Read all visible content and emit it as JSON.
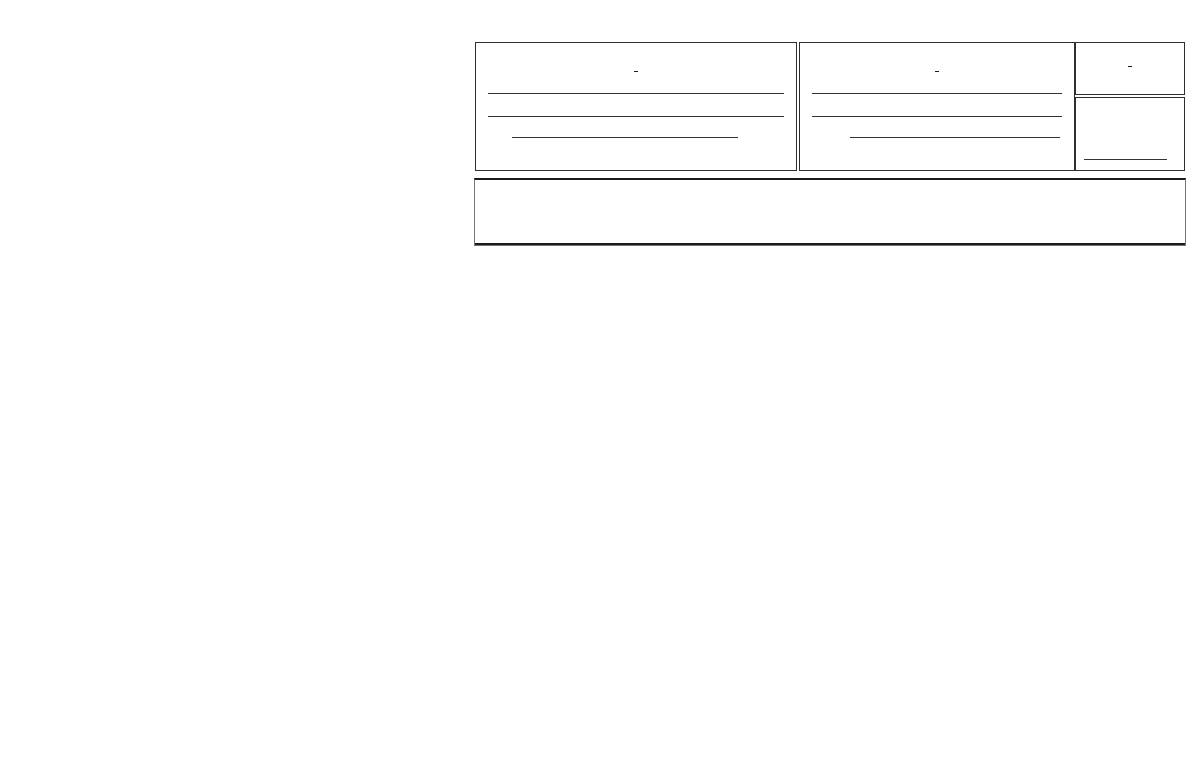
{
  "title": "HOUSING ASSISTANCE PAYMENTS REGISTER",
  "owner_section": {
    "heading": "OWNER",
    "name_label": "Name",
    "address_label": "Address",
    "zip_code_label": "Zip Code"
  },
  "family_section": {
    "heading": "FAMILY",
    "name_label": "Name",
    "address_label": "Address",
    "zip_code_label": "Zip Code"
  },
  "voucher_section": {
    "heading": "VOUCHER NO."
  },
  "unit_size_section": {
    "label": "Unit Size",
    "bedroom_label": "BR."
  },
  "register_table": {
    "columns": [
      {
        "lines": [
          "Effective",
          "Date of",
          "Lease"
        ],
        "number": "(1)"
      },
      {
        "lines": [
          "Expiration",
          "Date of",
          "Lease"
        ],
        "number": "(2)"
      },
      {
        "lines": [
          "Term.",
          "Notice",
          "Required",
          "(days)"
        ],
        "number": "(3)"
      },
      {
        "lines": [
          "Term.",
          "Notice",
          "Given",
          "(days)"
        ],
        "number": "(4)"
      },
      {
        "lines": [
          "Date",
          "Vacated"
        ],
        "number": "(5)"
      },
      {
        "lines": [
          "Days of",
          "Vacancy",
          "Due",
          "Owner"
        ],
        "number": "(6)"
      },
      {
        "lines": [
          "Effective",
          "Date of",
          "Payment",
          "Change"
        ],
        "number": "(7)"
      },
      {
        "lines": [
          "Gross",
          "Payment"
        ],
        "number": "(8)"
      },
      {
        "lines": [
          "Utility",
          "Allowance"
        ],
        "number": "(9)"
      },
      {
        "lines": [
          "Contract",
          "Rent"
        ],
        "number": "(10)"
      },
      {
        "lines": [
          "Family",
          "Payment",
          "To",
          "Owner"
        ],
        "number": "(11)"
      },
      {
        "lines": [
          "Utility",
          "Payment",
          "To",
          "Family"
        ],
        "number": "(12)"
      },
      {
        "lines": [
          "Monthly",
          "HAP",
          "To",
          "Owner"
        ],
        "number": "(13)"
      }
    ],
    "currency_symbol": "$",
    "currency_columns": [
      "(8)",
      "(9)",
      "(10)",
      "(11)",
      "(12)",
      "(13)"
    ],
    "row_count": 14
  },
  "footer": {
    "left": "FORM HF-28 HOUSING FORMS, INC., RALEIGH, NC (800) 334-1562",
    "right": "To reorder contact Housing Forms at www.housing-forms.com or (800) 334-1562"
  }
}
